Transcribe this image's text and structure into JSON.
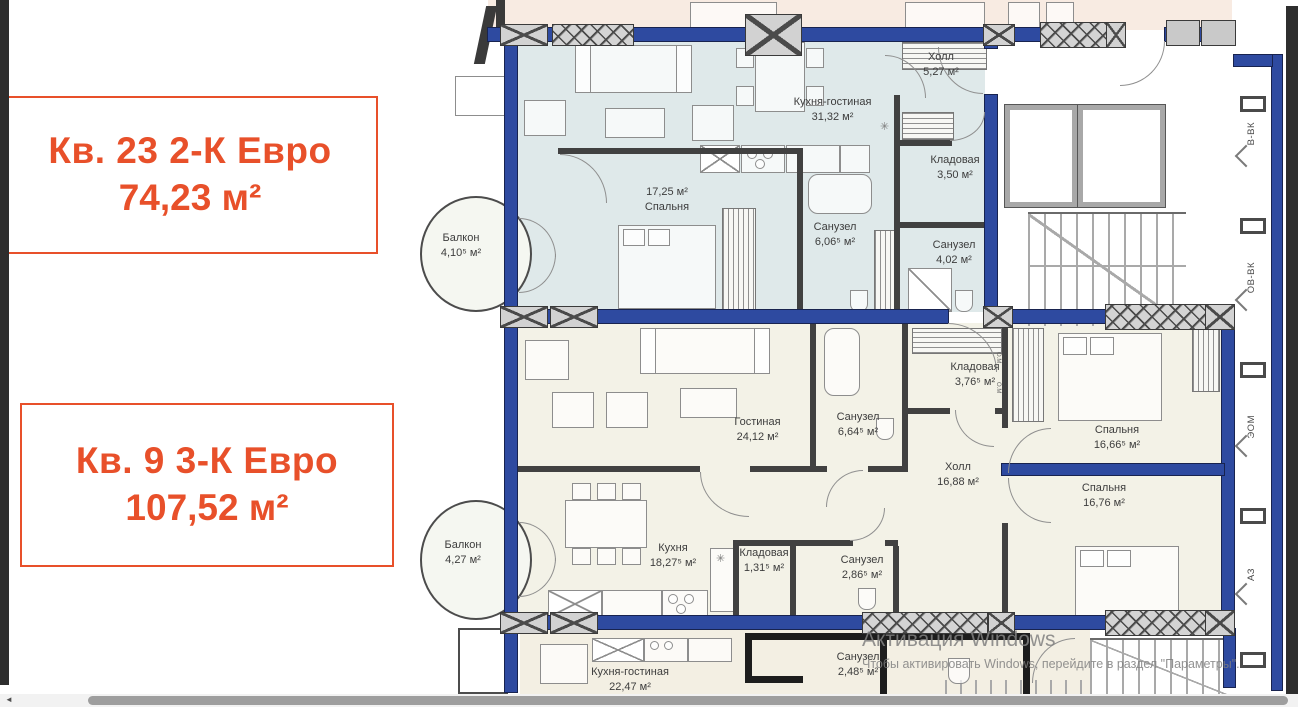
{
  "accent_color": "#e8502a",
  "cards": [
    {
      "title": "Кв. 23 2-К Евро",
      "area": "74,23 м²"
    },
    {
      "title": "Кв. 9 3-К Евро",
      "area": "107,52 м²"
    }
  ],
  "plan": {
    "apt23": {
      "rooms": [
        {
          "name": "Кухня-гостиная",
          "area": "31,32 м²"
        },
        {
          "name": "Холл",
          "area": "5,27 м²"
        },
        {
          "name": "Спальня",
          "area": "17,25 м²"
        },
        {
          "name": "Кладовая",
          "area": "3,50 м²"
        },
        {
          "name": "Санузел",
          "area": "6,06⁵ м²"
        },
        {
          "name": "Санузел",
          "area": "4,02 м²"
        },
        {
          "name": "Балкон",
          "area": "4,10⁵ м²"
        }
      ]
    },
    "apt9": {
      "rooms": [
        {
          "name": "Гостиная",
          "area": "24,12 м²"
        },
        {
          "name": "Санузел",
          "area": "6,64⁵ м²"
        },
        {
          "name": "Кладовая",
          "area": "3,76⁵ м²"
        },
        {
          "name": "Холл",
          "area": "16,88 м²"
        },
        {
          "name": "Спальня",
          "area": "16,66⁵ м²"
        },
        {
          "name": "Спальня",
          "area": "16,76 м²"
        },
        {
          "name": "Кухня",
          "area": "18,27⁵ м²"
        },
        {
          "name": "Кладовая",
          "area": "1,31⁵ м²"
        },
        {
          "name": "Санузел",
          "area": "2,86⁵ м²"
        },
        {
          "name": "Балкон",
          "area": "4,27 м²"
        }
      ]
    },
    "neighbor": {
      "rooms": [
        {
          "name": "Кухня-гостиная",
          "area": "22,47 м²"
        },
        {
          "name": "Санузел",
          "area": "2,48⁵ м²"
        }
      ]
    },
    "shaft_labels": [
      "В-ВК",
      "ОВ-ВК",
      "ЭОМ",
      "АЗ"
    ],
    "duct_label": "О.М"
  },
  "watermark": {
    "line1": "Активация Windows",
    "line2": "Чтобы активировать Windows, перейдите в раздел \"Параметры\"."
  }
}
